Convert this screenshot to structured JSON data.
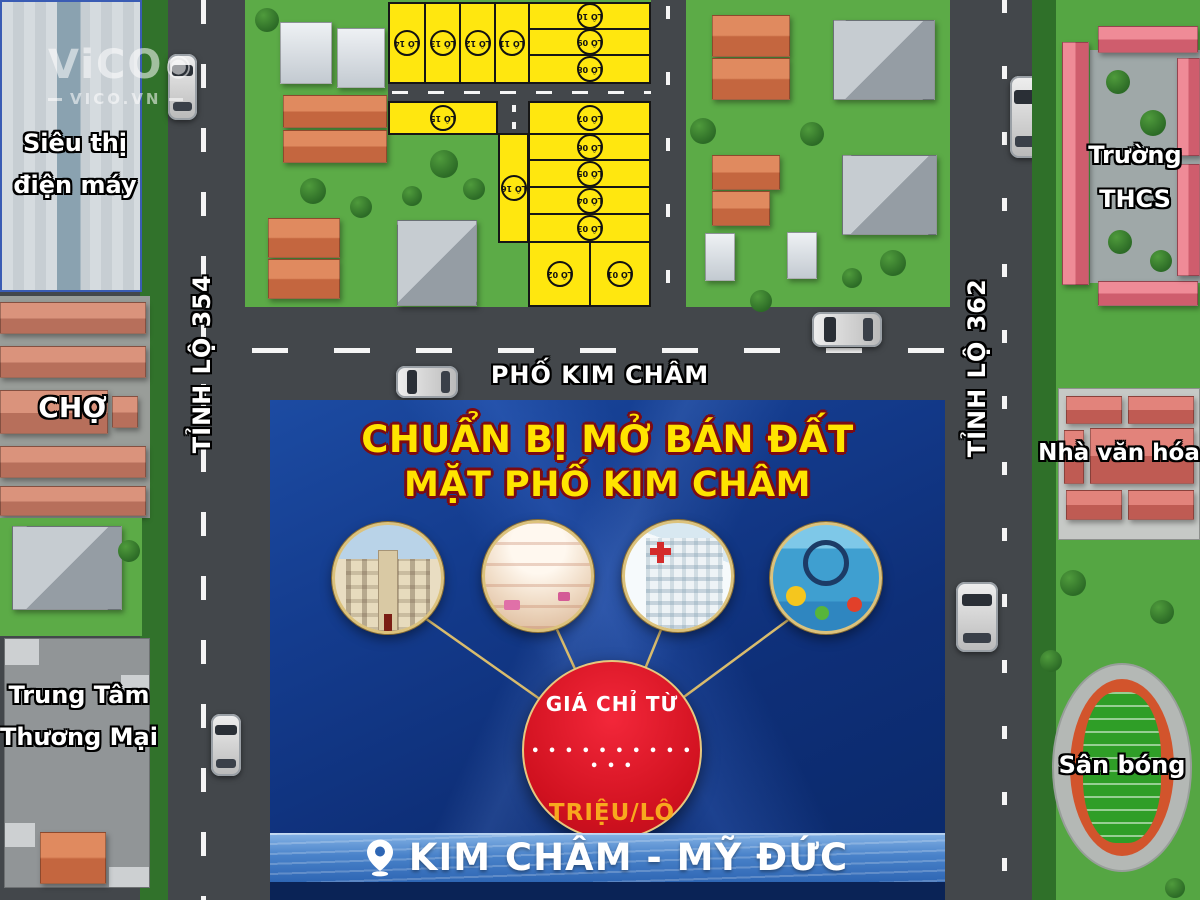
{
  "logo": {
    "brand": "ViCO",
    "domain": "VICO.VN"
  },
  "landmarks": {
    "supermarket_line1": "Siêu thị",
    "supermarket_line2": "điện máy",
    "market": "CHỢ",
    "trade_center_line1": "Trung Tâm",
    "trade_center_line2": "Thương Mại",
    "school_line1": "Trường",
    "school_line2": "THCS",
    "culture_house": "Nhà văn hóa",
    "stadium": "Sân bóng"
  },
  "roads": {
    "left_vertical": "TỈNH LỘ 354",
    "right_vertical": "TỈNH LỘ 362",
    "main_horizontal": "PHỐ KIM CHÂM"
  },
  "lots": [
    {
      "label": "LÔ 01"
    },
    {
      "label": "LÔ 02"
    },
    {
      "label": "LÔ 03"
    },
    {
      "label": "LÔ 04"
    },
    {
      "label": "LÔ 05"
    },
    {
      "label": "LÔ 06"
    },
    {
      "label": "LÔ 07"
    },
    {
      "label": "LÔ 08"
    },
    {
      "label": "LÔ 09"
    },
    {
      "label": "LÔ 10"
    },
    {
      "label": "LÔ 11"
    },
    {
      "label": "LÔ 12"
    },
    {
      "label": "LÔ 13"
    },
    {
      "label": "LÔ 14"
    },
    {
      "label": "LÔ 15"
    },
    {
      "label": "LÔ 16"
    }
  ],
  "ad_panel": {
    "title_line1": "CHUẨN BỊ MỞ BÁN ĐẤT",
    "title_line2": "MẶT PHỐ KIM CHÂM",
    "price_prefix": "GIÁ CHỈ TỪ",
    "price_dots": "• • • • • • • • • • • • •",
    "price_unit": "TRIỆU/LÔ",
    "location": "KIM CHÂM - MỸ ĐỨC",
    "features": [
      {
        "icon": "town-hall"
      },
      {
        "icon": "shopping-mall"
      },
      {
        "icon": "hospital"
      },
      {
        "icon": "indoor-playground"
      }
    ]
  },
  "colors": {
    "lot_yellow": "#ffe70f",
    "panel_blue": "#123a8e",
    "accent_gold": "#d9bc6d",
    "price_red": "#d0111f",
    "title_yellow": "#ffe400"
  }
}
